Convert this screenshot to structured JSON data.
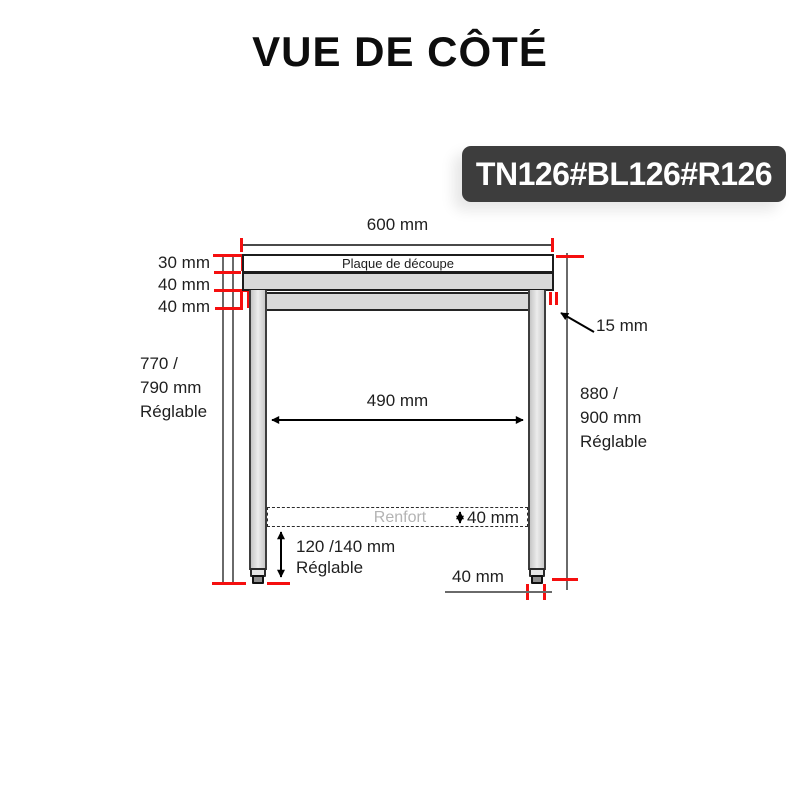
{
  "title": "VUE DE CÔTÉ",
  "badge": {
    "label": "TN126#BL126#R126"
  },
  "diagram": {
    "top_width": "600 mm",
    "plate_label": "Plaque de découpe",
    "left_dims": [
      "30 mm",
      "40 mm",
      "40 mm"
    ],
    "overhang": "15 mm",
    "left_height": {
      "line1": "770 /",
      "line2": "790 mm",
      "line3": "Réglable"
    },
    "right_height": {
      "line1": "880 /",
      "line2": "900 mm",
      "line3": "Réglable"
    },
    "inner_width": "490 mm",
    "renfort": {
      "label": "Renfort",
      "height": "40 mm"
    },
    "foot_adjust": {
      "line1": "120 /140 mm",
      "line2": "Réglable"
    },
    "foot_width": "40 mm"
  },
  "colors": {
    "badge_bg": "#3d3d3d",
    "accent_red": "#f50f0f",
    "steel_gray": "#d9d9d9"
  }
}
